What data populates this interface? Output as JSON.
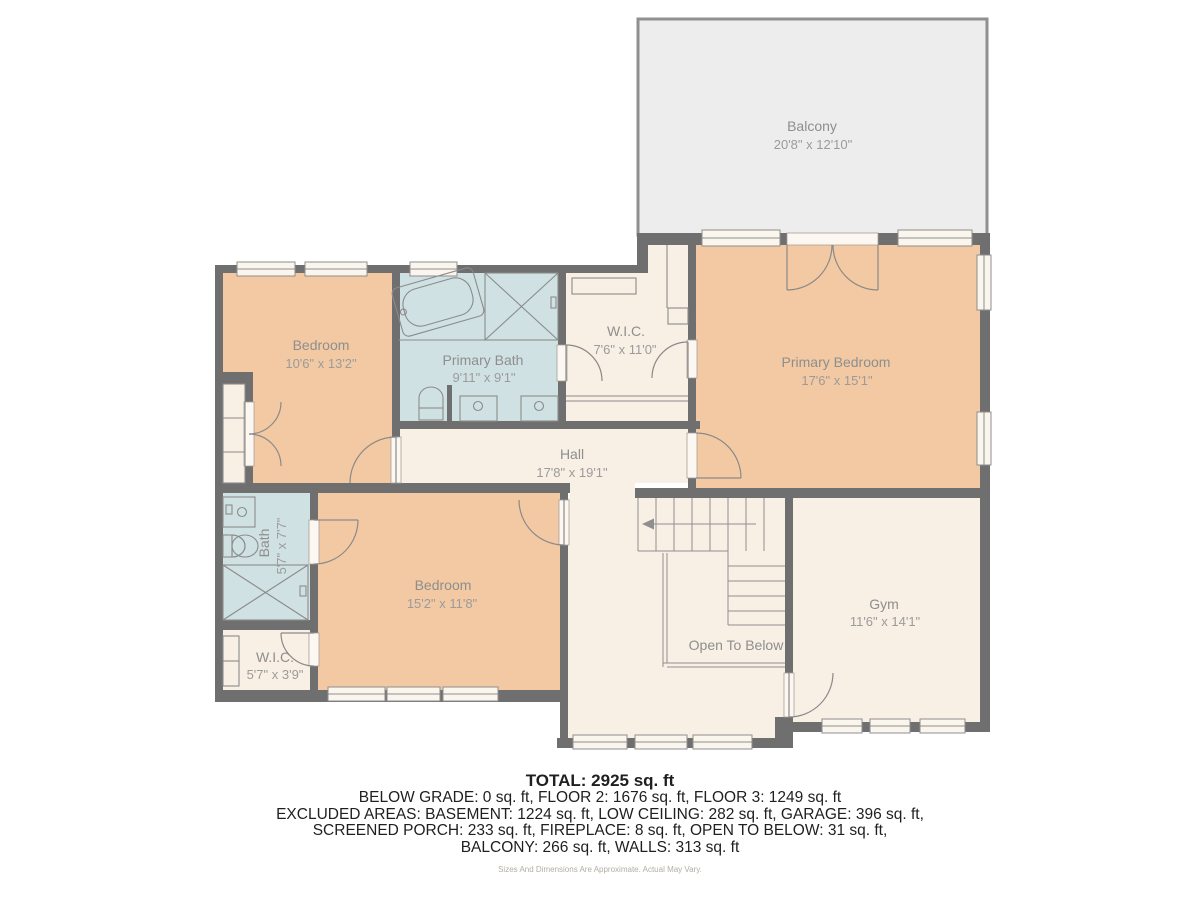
{
  "colors": {
    "wall": "#6f6f6f",
    "peach": "#f2c9a3",
    "blue": "#d0e1e3",
    "cream": "#f8efe5",
    "balcony": "#ededed",
    "label": "#8e8e8e",
    "dim": "#9b9b9b",
    "footer": "#1f1f1f"
  },
  "rooms": {
    "balcony": {
      "name": "Balcony",
      "dims": "20'8\" x 12'10\""
    },
    "bedroom1": {
      "name": "Bedroom",
      "dims": "10'6\" x 13'2\""
    },
    "primary_bath": {
      "name": "Primary Bath",
      "dims": "9'11\" x 9'1\""
    },
    "wic_upper": {
      "name": "W.I.C.",
      "dims": "7'6\" x 11'0\""
    },
    "primary_bedroom": {
      "name": "Primary Bedroom",
      "dims": "17'6\" x 15'1\""
    },
    "hall": {
      "name": "Hall",
      "dims": "17'8\" x 19'1\""
    },
    "bath": {
      "name": "Bath",
      "dims": "5'7\" x 7'7\""
    },
    "bedroom2": {
      "name": "Bedroom",
      "dims": "15'2\" x 11'8\""
    },
    "wic_lower": {
      "name": "W.I.C.",
      "dims": "5'7\" x 3'9\""
    },
    "gym": {
      "name": "Gym",
      "dims": "11'6\" x 14'1\""
    },
    "open_to_below": {
      "name": "Open To Below"
    }
  },
  "summary": {
    "total": "TOTAL: 2925 sq. ft",
    "breakdown": [
      "BELOW GRADE: 0 sq. ft, FLOOR 2: 1676 sq. ft, FLOOR 3: 1249 sq. ft",
      "EXCLUDED AREAS: BASEMENT: 1224 sq. ft, LOW CEILING: 282 sq. ft, GARAGE: 396 sq. ft,",
      "SCREENED PORCH: 233 sq. ft, FIREPLACE: 8 sq. ft, OPEN TO BELOW: 31 sq. ft,",
      "BALCONY: 266 sq. ft, WALLS: 313 sq. ft"
    ],
    "disclaimer": "Sizes And Dimensions Are Approximate. Actual May Vary."
  }
}
